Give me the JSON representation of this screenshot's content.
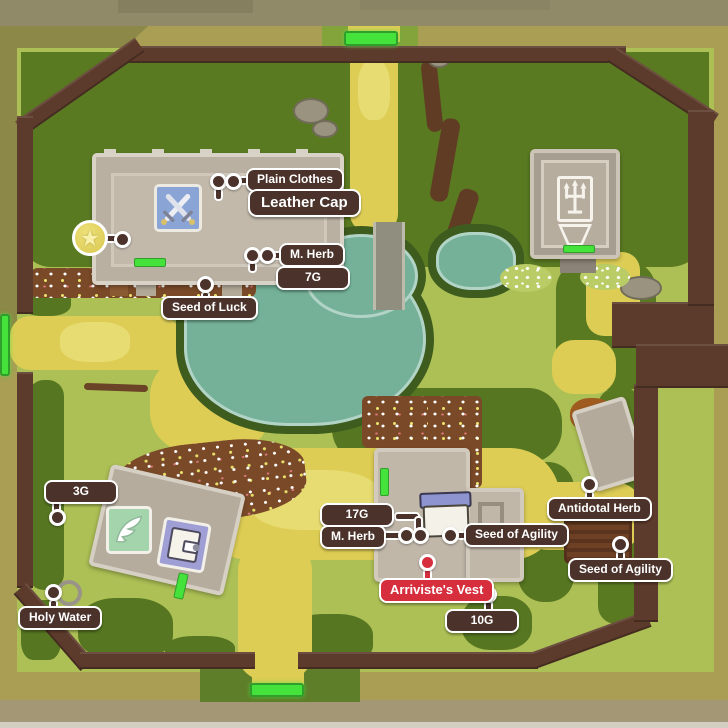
{
  "callouts": {
    "plain_clothes": "Plain Clothes",
    "leather_cap": "Leather Cap",
    "m_herb_shop": "M. Herb",
    "price_7g": "7G",
    "seed_of_luck": "Seed of Luck",
    "price_3g": "3G",
    "holy_water": "Holy Water",
    "price_17g": "17G",
    "m_herb_inn": "M. Herb",
    "seed_of_agility_inn": "Seed of Agility",
    "arrivistes_vest": "Arriviste's Vest",
    "price_10g": "10G",
    "antidotal_herb": "Antidotal Herb",
    "seed_of_agility_garden": "Seed of Agility"
  },
  "icons": {
    "mini_medal": "★",
    "weapon_shop": "crossed-swords",
    "church": "trident",
    "item_shop": "wing",
    "inn": "bed",
    "gate": "green-door-bar"
  },
  "colors": {
    "label_bg": "#4b332b",
    "label_text": "#ffffff",
    "label_border": "#ffffff",
    "highlight_bg": "#d62e3d",
    "gate_green": "#46e23c",
    "pond": "#74b198",
    "wall": "#5d3b2c",
    "grass_dark": "#5a7a22",
    "grass_light": "#adc055",
    "path_yellow": "#ddcd55",
    "building": "#b9b0a2"
  }
}
